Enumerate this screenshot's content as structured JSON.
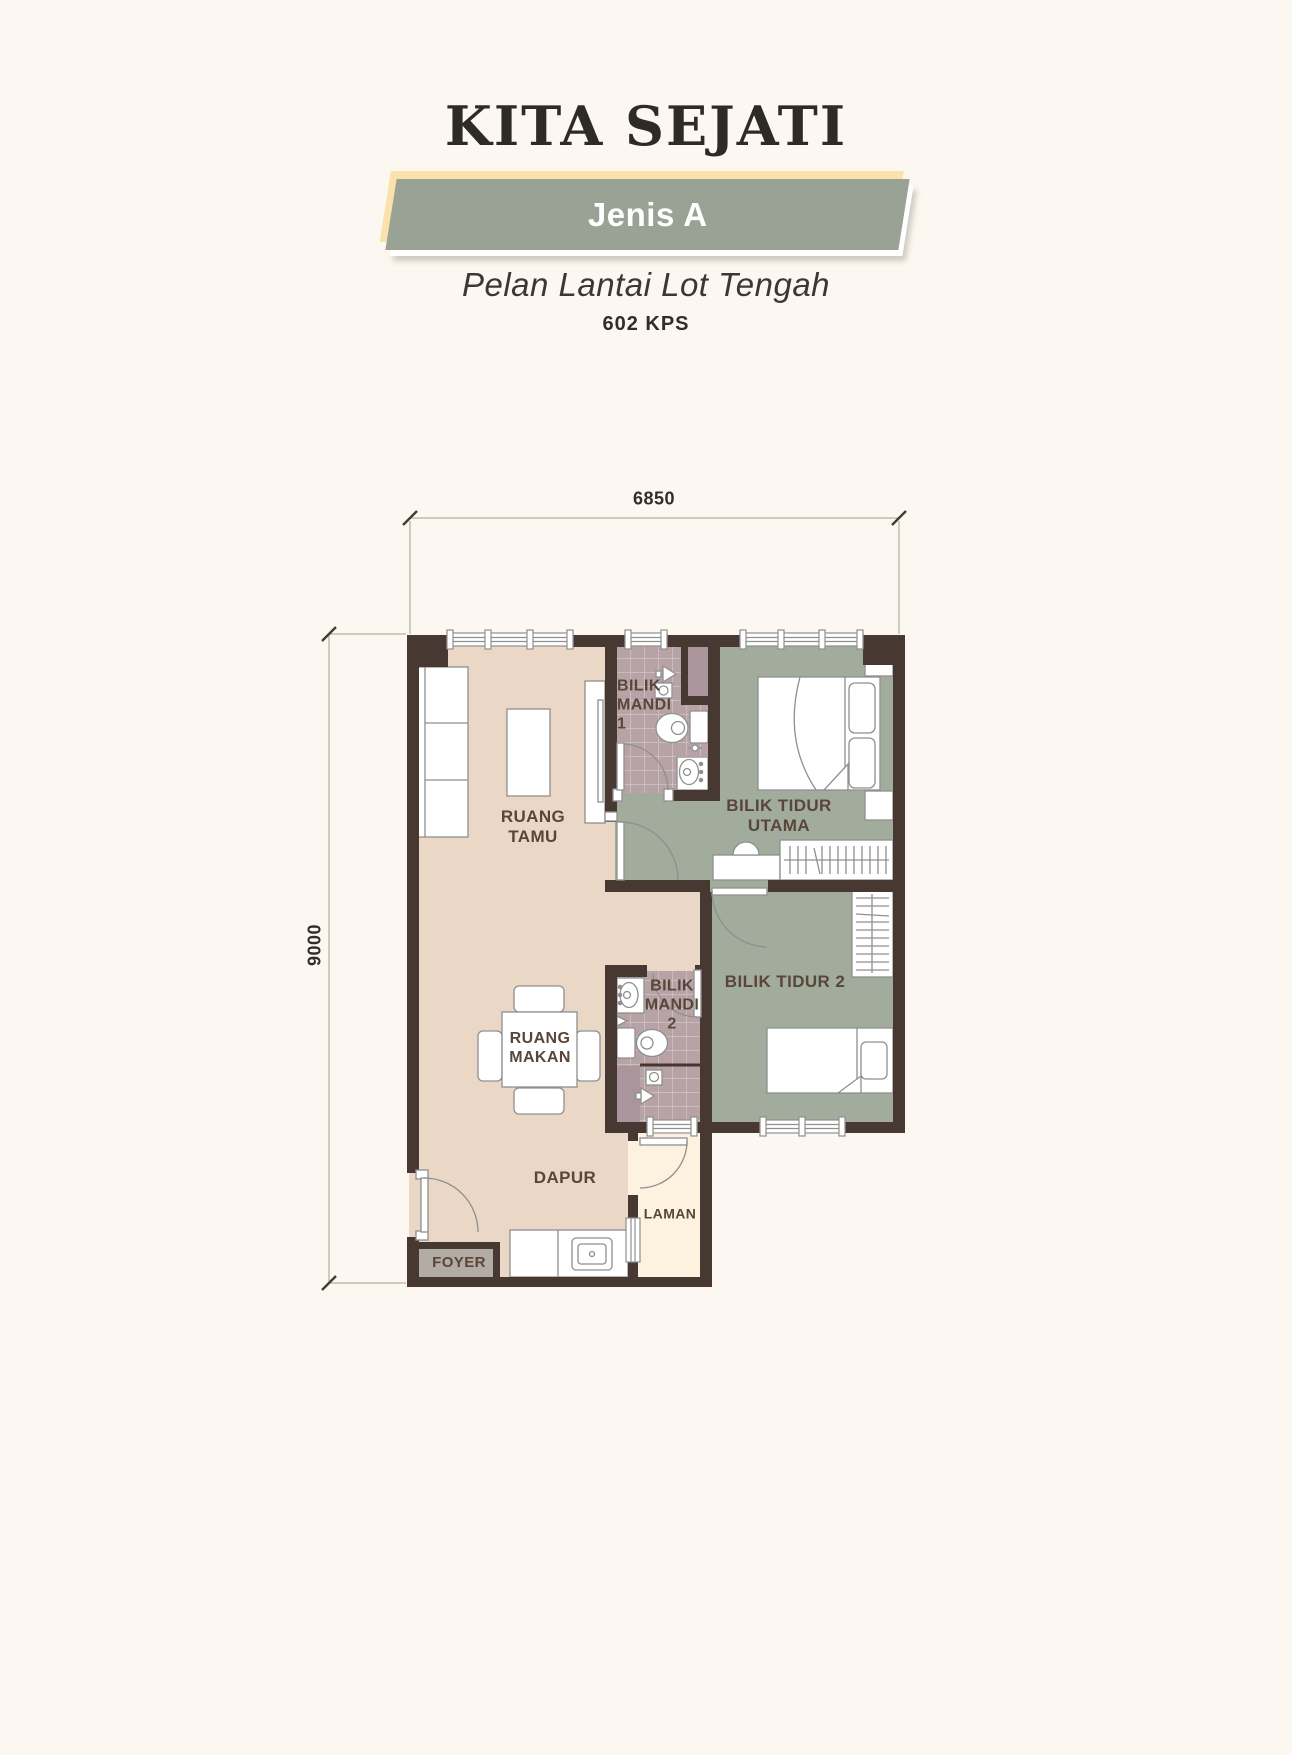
{
  "header": {
    "title": "KITA SEJATI",
    "badge": "Jenis A",
    "subtitle": "Pelan Lantai Lot Tengah",
    "area": "602 KPS"
  },
  "dimensions": {
    "width_mm": "6850",
    "height_mm": "9000"
  },
  "rooms": {
    "ruang_tamu": {
      "lines": [
        "RUANG",
        "TAMU"
      ]
    },
    "bilik_mandi_1": {
      "lines": [
        "BILIK",
        "MANDI",
        "1"
      ]
    },
    "bilik_tidur_utama": {
      "lines": [
        "BILIK TIDUR",
        "UTAMA"
      ]
    },
    "bilik_tidur_2": {
      "label": "BILIK TIDUR 2"
    },
    "bilik_mandi_2": {
      "lines": [
        "BILIK",
        "MANDI",
        "2"
      ]
    },
    "ruang_makan": {
      "lines": [
        "RUANG",
        "MAKAN"
      ]
    },
    "dapur": {
      "label": "DAPUR"
    },
    "laman": {
      "label": "LAMAN"
    },
    "foyer": {
      "label": "FOYER"
    }
  },
  "colors": {
    "page_background": "#fcf8f1",
    "badge_green": "#99a294",
    "badge_backdrop": "#fbe2ad",
    "floor_living": "#ebd7c6",
    "floor_bedroom": "#a2ac9c",
    "floor_bathroom": "#b7a3a6",
    "floor_shaft": "#a9959b",
    "floor_laman": "#fdf2df",
    "floor_foyer": "#b2aca5",
    "wall": "#473931",
    "label_text": "#594639",
    "furniture_stroke": "#8f8f8f"
  }
}
